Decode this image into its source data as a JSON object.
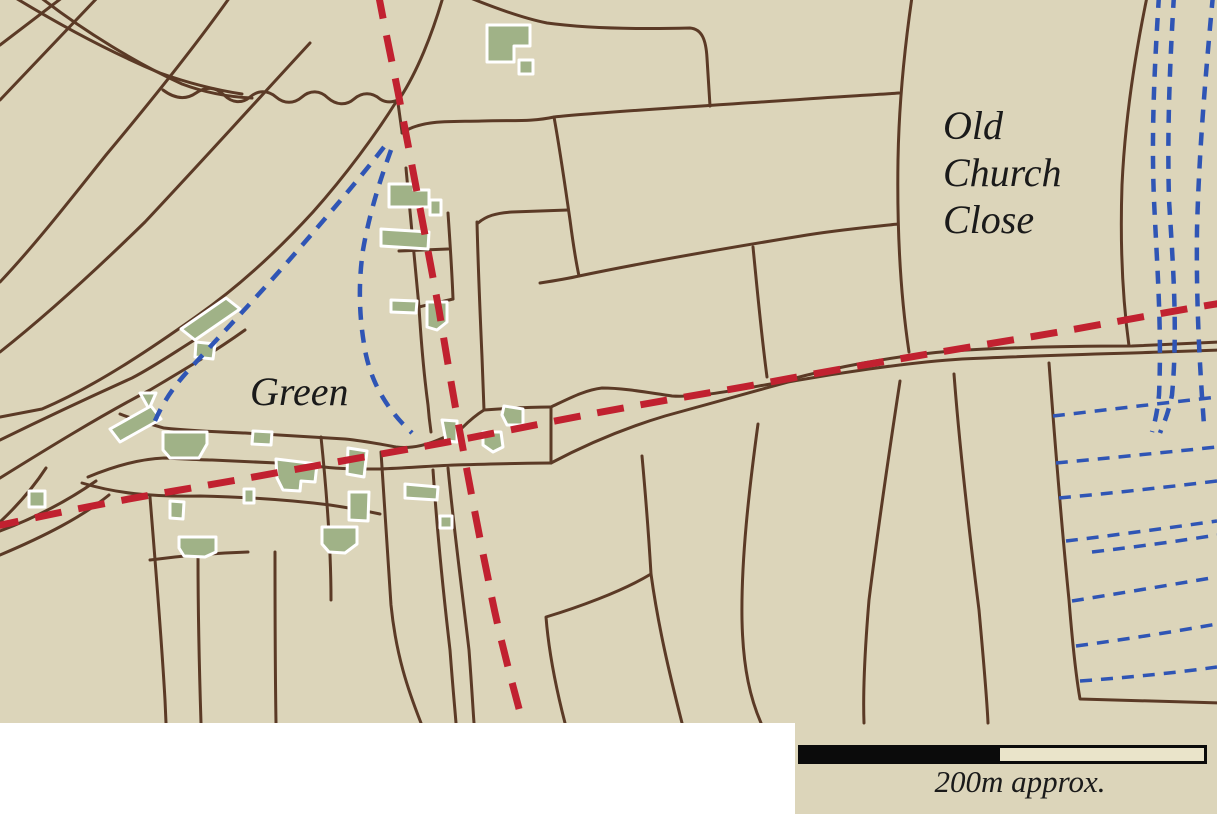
{
  "map": {
    "labels": {
      "field": "Old Church Close",
      "green": "Green"
    },
    "scale": {
      "label": "200m approx."
    },
    "colors": {
      "background": "#dcd5ba",
      "boundary_brown": "#5b3a26",
      "route_red": "#c12130",
      "drainage_blue": "#2f55b5",
      "building_fill": "#a0b287",
      "building_stroke": "#ffffff",
      "text_ink": "#1a1a1a",
      "scale_dark": "#0b0b0b",
      "scale_light": "#eae4ca"
    }
  }
}
